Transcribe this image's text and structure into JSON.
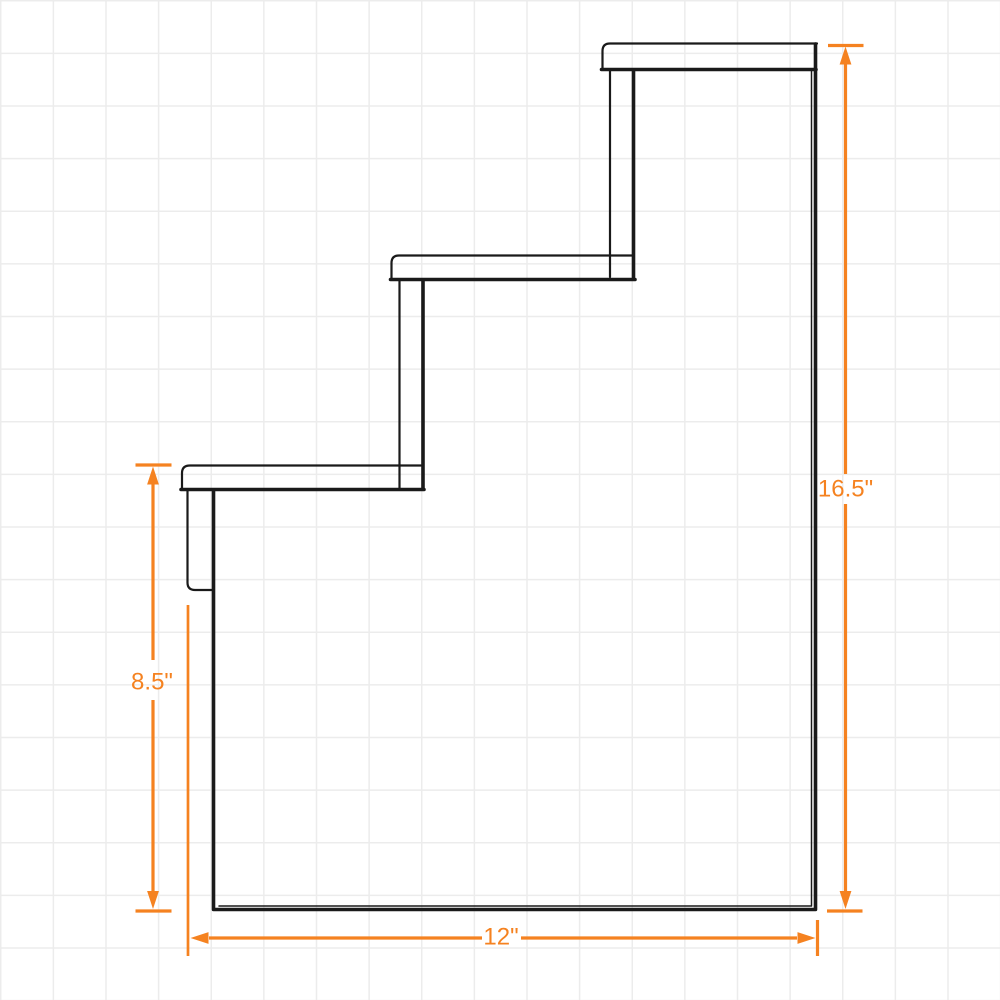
{
  "annotations": {
    "overall_height": "16.5\"",
    "lower_section_height": "8.5\"",
    "base_depth": "12\""
  },
  "colors": {
    "dimension_accent": "#F58220",
    "drawing_outline": "#1A1A1A",
    "grid_line": "#ECECEC",
    "background": "#FFFFFF"
  }
}
